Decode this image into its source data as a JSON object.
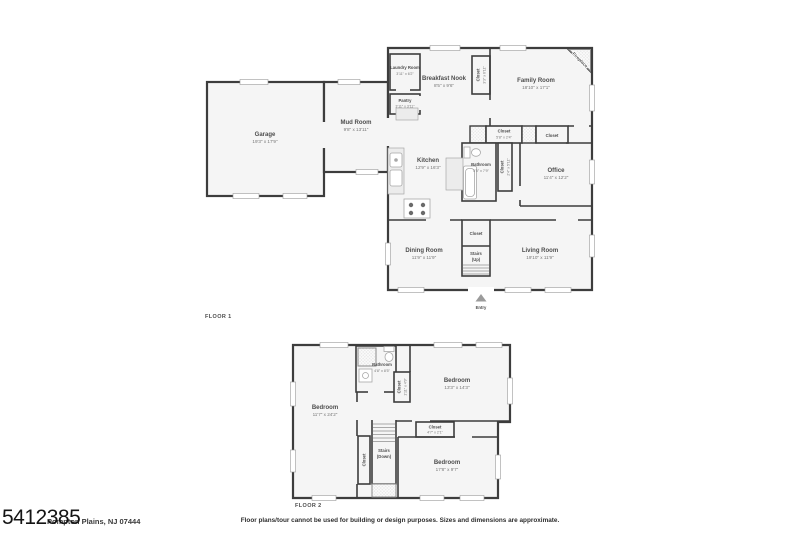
{
  "meta": {
    "floor1_label": "FLOOR 1",
    "floor2_label": "FLOOR 2",
    "entry_label": "Entry",
    "listing_number": "5412385",
    "address": "Pompton Plains, NJ 07444",
    "disclaimer": "Floor plans/tour cannot be used for building or design purposes. Sizes and dimensions are approximate.",
    "colors": {
      "wall": "#3d3d3d",
      "room_fill": "#f5f5f5",
      "label": "#4d4d4d",
      "dims": "#767676",
      "background": "#ffffff"
    }
  },
  "floor1": {
    "garage": {
      "name": "Garage",
      "dims": "19'3\" x 17'9\""
    },
    "mud_room": {
      "name": "Mud Room",
      "dims": "9'8\" x 13'11\""
    },
    "laundry_room": {
      "name": "Laundry Room",
      "dims": "3'11\" x 6'2\""
    },
    "pantry": {
      "name": "Pantry",
      "dims": "3'11\" x 3'11\""
    },
    "breakfast_nook": {
      "name": "Breakfast Nook",
      "dims": "8'5\" x 9'6\""
    },
    "nook_closet": {
      "name": "Closet",
      "dims": "3'3\" x 6'11\""
    },
    "family_room": {
      "name": "Family Room",
      "dims": "18'10\" x 17'1\""
    },
    "fireplace": {
      "name": "Fireplace"
    },
    "kitchen": {
      "name": "Kitchen",
      "dims": "12'9\" x 16'3\""
    },
    "bathroom": {
      "name": "Bathroom",
      "dims": "5'5\" x 7'9\""
    },
    "hall_closet": {
      "name": "Closet",
      "dims": "5'8\" x 2'4\""
    },
    "office_closet": {
      "name": "Closet"
    },
    "bath_closet": {
      "name": "Closet",
      "dims": "2'4\" x 5'11\""
    },
    "office": {
      "name": "Office",
      "dims": "11'4\" x 12'2\""
    },
    "dining_room": {
      "name": "Dining Room",
      "dims": "11'9\" x 11'9\""
    },
    "stair_closet": {
      "name": "Closet"
    },
    "stairs": {
      "name": "Stairs",
      "dir": "(Up)"
    },
    "living_room": {
      "name": "Living Room",
      "dims": "19'10\" x 11'9\""
    }
  },
  "floor2": {
    "bedroom_left": {
      "name": "Bedroom",
      "dims": "11'7\" x 24'2\""
    },
    "bathroom": {
      "name": "Bathroom",
      "dims": "4'8\" x 8'5\""
    },
    "bath_closet": {
      "name": "Closet",
      "dims": "1'11\" x 4'9\""
    },
    "bedroom_right": {
      "name": "Bedroom",
      "dims": "13'3\" x 14'3\""
    },
    "mid_closet": {
      "name": "Closet",
      "dims": "4'7\" x 2'1\""
    },
    "bedroom_bottom": {
      "name": "Bedroom",
      "dims": "17'8\" x 9'7\""
    },
    "stairs": {
      "name": "Stairs",
      "dir": "(Down)"
    },
    "stair_closet": {
      "name": "Closet"
    }
  }
}
